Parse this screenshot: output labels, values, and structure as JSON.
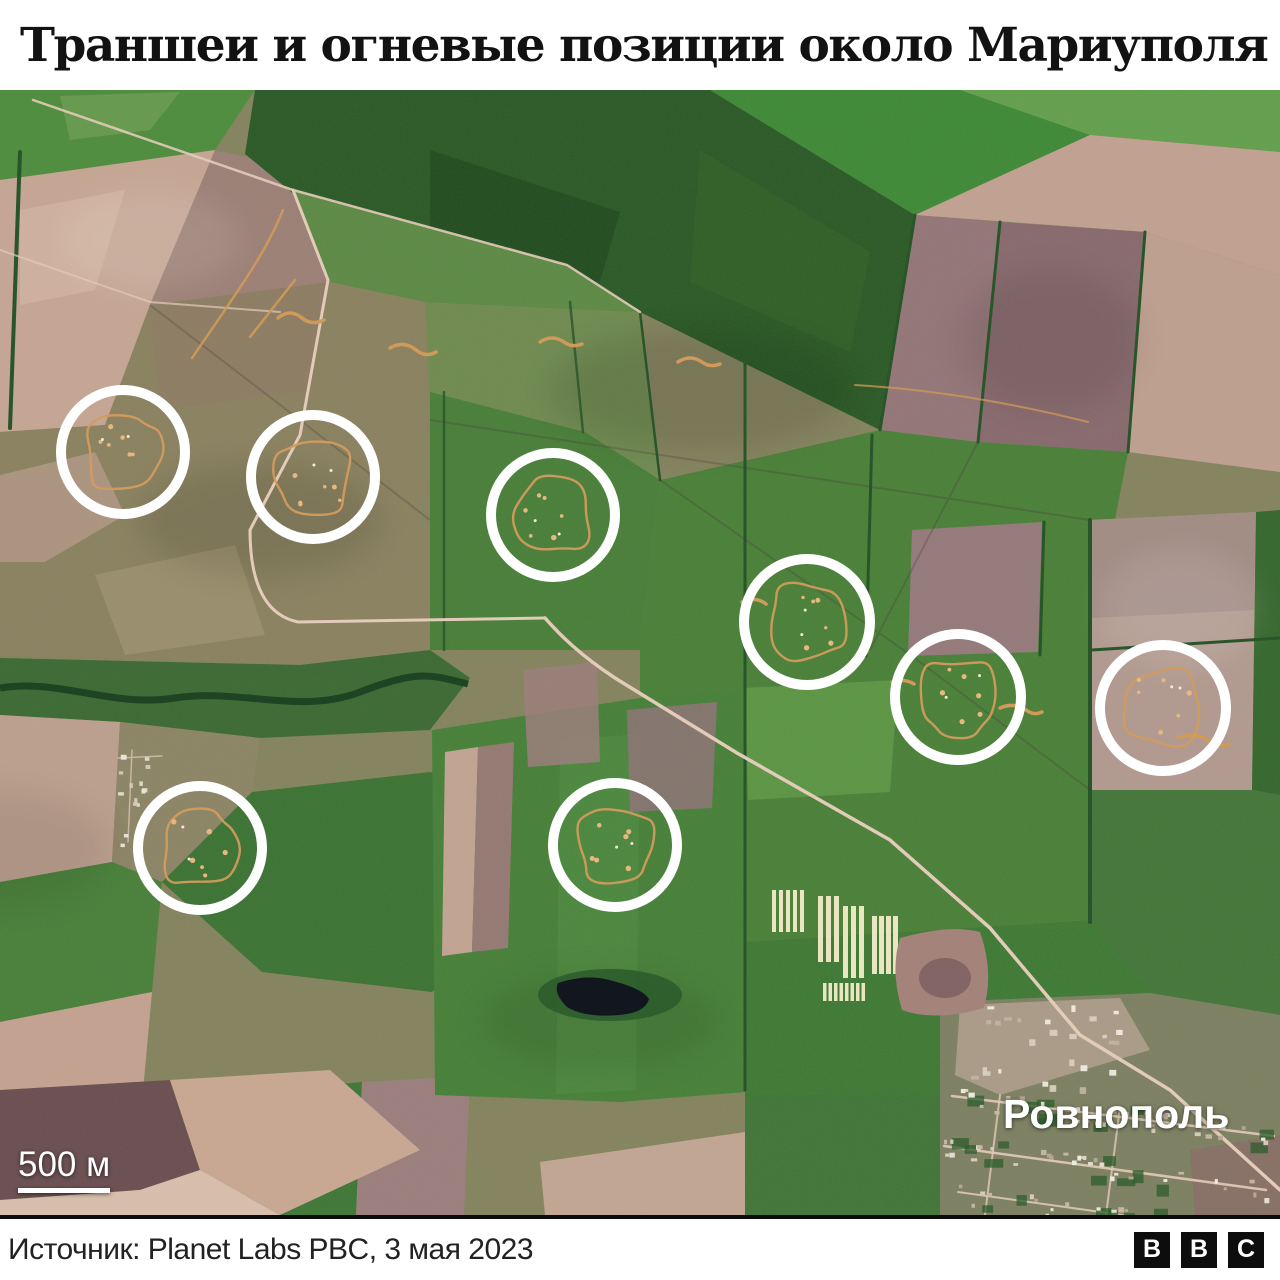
{
  "title": "Траншеи и огневые позиции около Мариуполя",
  "map": {
    "scale": {
      "label": "500 м",
      "bar_color": "#ffffff"
    },
    "village": {
      "label": "Ровнополь"
    },
    "marker_style": {
      "stroke": "#ffffff",
      "stroke_width": 10
    },
    "trench_color": "#d29b5d",
    "markers": [
      {
        "cx": 123,
        "cy": 362,
        "r": 62
      },
      {
        "cx": 313,
        "cy": 387,
        "r": 62
      },
      {
        "cx": 553,
        "cy": 425,
        "r": 62
      },
      {
        "cx": 807,
        "cy": 532,
        "r": 63
      },
      {
        "cx": 958,
        "cy": 607,
        "r": 63
      },
      {
        "cx": 1163,
        "cy": 618,
        "r": 63
      },
      {
        "cx": 200,
        "cy": 758,
        "r": 62
      },
      {
        "cx": 615,
        "cy": 755,
        "r": 62
      }
    ]
  },
  "footer": {
    "source": "Источник: Planet Labs PBC, 3 мая 2023",
    "logo": {
      "letters": [
        "B",
        "B",
        "C"
      ]
    }
  }
}
